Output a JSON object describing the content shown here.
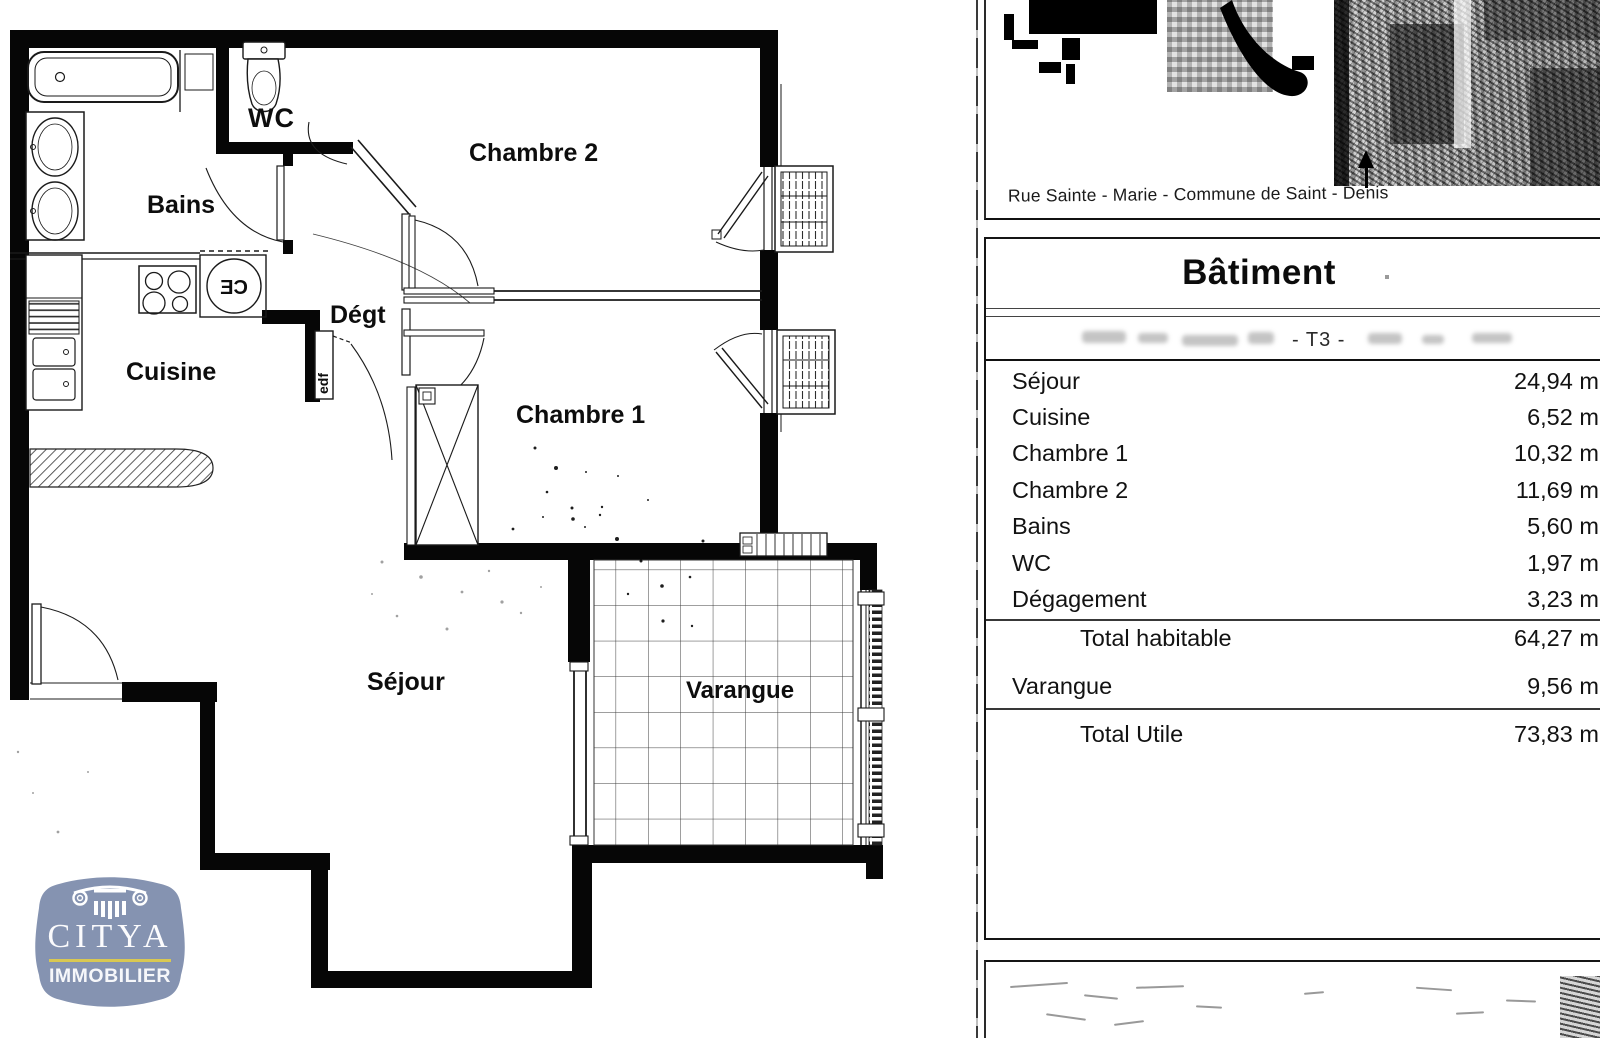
{
  "plan": {
    "rooms": {
      "wc": "WC",
      "bains": "Bains",
      "chambre2": "Chambre 2",
      "degt": "Dégt",
      "cuisine": "Cuisine",
      "chambre1": "Chambre 1",
      "sejour": "Séjour",
      "varangue": "Varangue"
    },
    "fixtures": {
      "water_heater": "CE",
      "electric_panel": "edf"
    }
  },
  "panel": {
    "address": "Rue Sainte - Marie - Commune de Saint - Denis",
    "table": {
      "title": "Bâtiment",
      "subtitle_visible": "- T3 -",
      "rows": [
        {
          "label": "Séjour",
          "value": "24,94 m2"
        },
        {
          "label": "Cuisine",
          "value": "6,52 m2"
        },
        {
          "label": "Chambre 1",
          "value": "10,32 m2"
        },
        {
          "label": "Chambre 2",
          "value": "11,69 m2"
        },
        {
          "label": "Bains",
          "value": "5,60 m2"
        },
        {
          "label": "WC",
          "value": "1,97 m2"
        },
        {
          "label": "Dégagement",
          "value": "3,23 m2"
        }
      ],
      "totals": [
        {
          "label": "Total habitable",
          "value": "64,27 m2"
        },
        {
          "label": "Varangue",
          "value": "9,56 m2"
        },
        {
          "label": "Total Utile",
          "value": "73,83 m2"
        }
      ]
    }
  },
  "logo": {
    "brand": "CITYA",
    "tagline": "IMMOBILIER",
    "colors": {
      "background": "#8593b1",
      "divider": "#d9c852"
    }
  }
}
